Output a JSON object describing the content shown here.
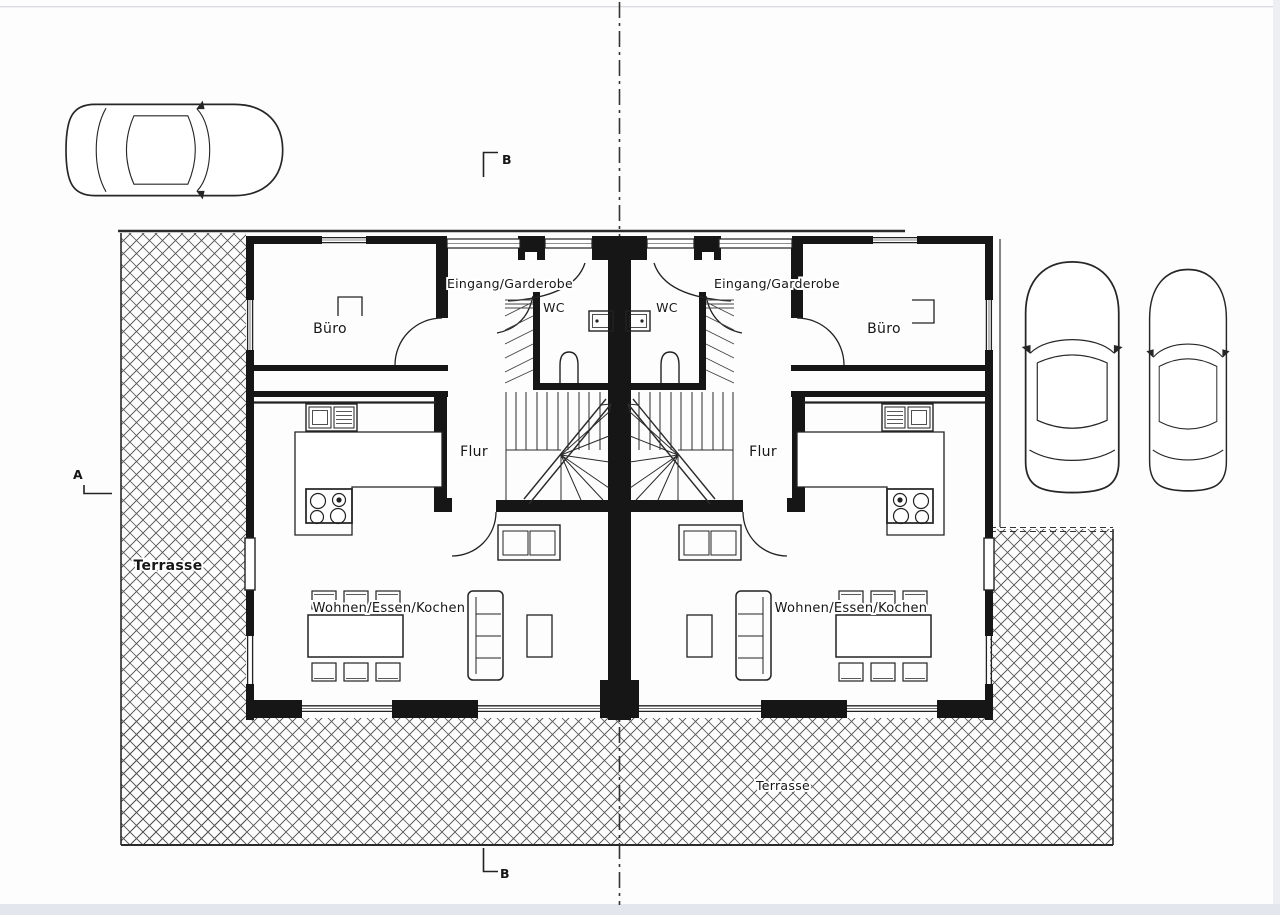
{
  "page": {
    "background": "#fdfdfd",
    "page_edge_color": "#e3e6ec"
  },
  "plan": {
    "colors": {
      "ink": "#161616",
      "hatch_line": "#4a4a4a",
      "paper": "#ffffff"
    },
    "units": {
      "left": {
        "eingang_garderobe": "Eingang/Garderobe",
        "wc": "WC",
        "buero": "Büro",
        "flur": "Flur",
        "wohnen_essen_kochen": "Wohnen/Essen/Kochen",
        "terrasse": "Terrasse"
      },
      "right": {
        "eingang_garderobe": "Eingang/Garderobe",
        "wc": "WC",
        "buero": "Büro",
        "flur": "Flur",
        "wohnen_essen_kochen": "Wohnen/Essen/Kochen",
        "terrasse": "Terrasse"
      }
    },
    "section_markers": {
      "a": "A",
      "b_top": "B",
      "b_bottom": "B"
    }
  }
}
